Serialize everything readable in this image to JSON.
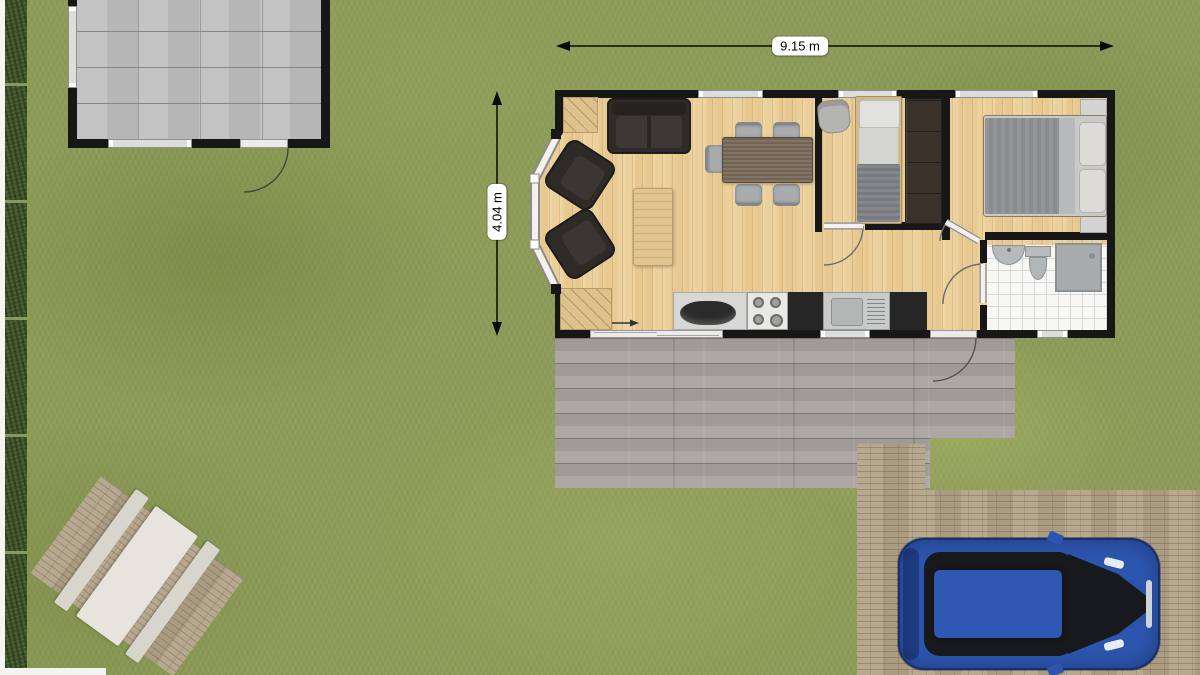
{
  "scene": {
    "title": "floor-plan-site-view",
    "dimensions": {
      "width": "9.15 m",
      "height": "4.04 m"
    },
    "colors": {
      "grass": "#8d9b58",
      "hedge": "#41552b",
      "walls": "#171717",
      "wood_floor": "#ecd09c",
      "deck": "#a8a39f",
      "shed_floor": "#c0c0c0",
      "paving_brick": "#b3a489",
      "bathroom_tile": "#f7f7f6",
      "car_body": "#2c55ad",
      "dark_furniture": "#2f2b29",
      "grey_fixture": "#b7babb"
    },
    "inventory": {
      "outdoor": [
        "hedge",
        "shed",
        "wood-deck",
        "brick-driveway",
        "car",
        "brick-patio",
        "picnic-table"
      ],
      "living_area": [
        "sofa",
        "armchair",
        "armchair",
        "coffee-table",
        "dining-table",
        "dining-chairs-x5",
        "corner-steps",
        "kitchen-counter",
        "stove",
        "kitchen-sink",
        "sliding-door"
      ],
      "bedroom_single": [
        "chair",
        "single-bed",
        "wardrobe"
      ],
      "bedroom_double": [
        "double-bed",
        "nightstand",
        "nightstand"
      ],
      "bathroom": [
        "wash-basin",
        "toilet",
        "shower"
      ]
    }
  }
}
